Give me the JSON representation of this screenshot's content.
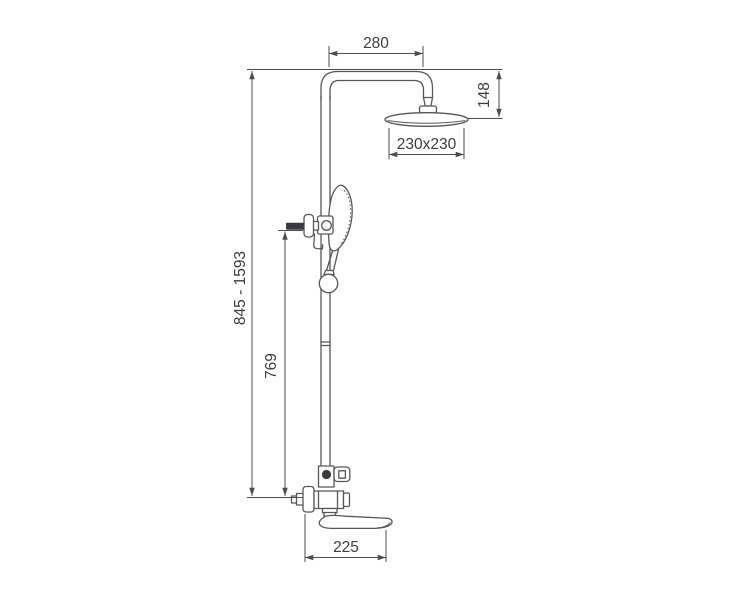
{
  "diagram": {
    "kind": "technical-dimension-drawing",
    "subject": "wall-mounted shower column with overhead shower, hand shower and tub spout",
    "colors": {
      "background": "#ffffff",
      "line": "#56575b",
      "dimension_line": "#4c4d50",
      "text": "#3d3d40",
      "dark_fill": "#3a3a3c"
    },
    "dimensions": {
      "arm_reach": "280",
      "head_drop": "148",
      "head_size": "230x230",
      "column_height_range": "845 - 1593",
      "hand_shower_height": "769",
      "spout_reach": "225"
    }
  }
}
